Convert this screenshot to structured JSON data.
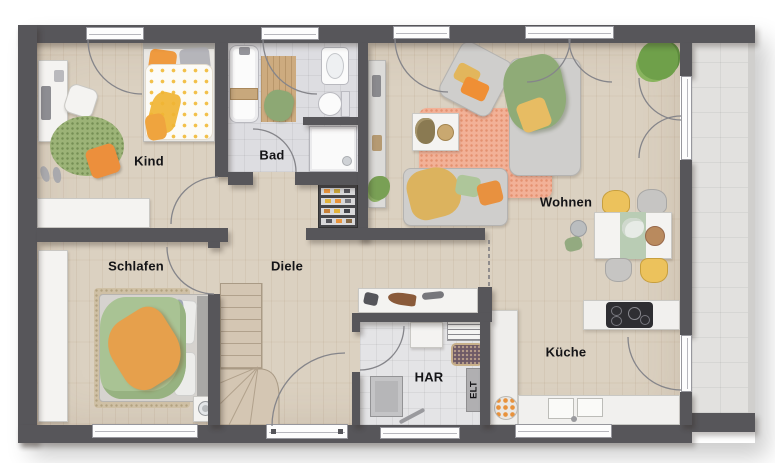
{
  "labels": {
    "kind": "Kind",
    "bad": "Bad",
    "wohnen": "Wohnen",
    "schlafen": "Schlafen",
    "diele": "Diele",
    "har": "HAR",
    "elt": "ELT",
    "kueche": "Küche"
  },
  "colors": {
    "wall": "#57565a",
    "wood_floor": "#dbd1c1",
    "bath_tile": "#dddde1",
    "har_tile": "#e4e4e6",
    "terrace_tile": "#e2e1df",
    "accent_orange": "#ec9440",
    "accent_green": "#9cb377",
    "accent_yellow": "#ecc25c",
    "rug_salmon": "#f2b197"
  }
}
